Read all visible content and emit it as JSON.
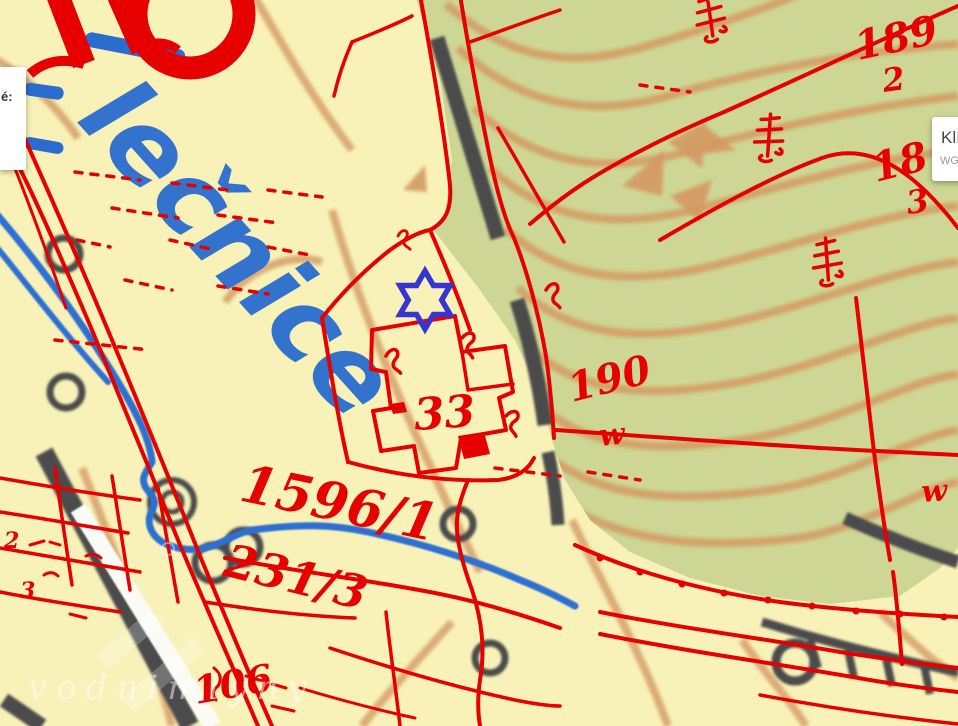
{
  "app": {
    "type": "historical-cadastral-map-viewer"
  },
  "panels": {
    "left_popup": {
      "text_fragment": "é:"
    },
    "right_popup": {
      "title_fragment": "Klí",
      "subtitle_fragment": "WG"
    }
  },
  "watermark": {
    "text": "vodnimlyny"
  },
  "marker": {
    "shape": "six-pointed-star-outline",
    "x": 425,
    "y": 300
  },
  "map": {
    "labels": {
      "stream_name": "lečnice",
      "parcel_1596": "1596/1",
      "parcel_231": "231/3",
      "house_33": "33",
      "num_189": "189",
      "num_189_sub": "2",
      "num_18": "18",
      "num_18_sub": "3",
      "num_190": "190",
      "w_forest_1": "w",
      "w_forest_2": "w",
      "num_106": "106",
      "small_2": "2",
      "small_3": "3"
    },
    "colors": {
      "paper": "#f8f2b9",
      "forest": "#cdd694",
      "contour": "#d49a63",
      "overlay_red": "#e60000",
      "water": "#2f70d2",
      "water_label": "#2a6dcf",
      "dark": "#4c4c4b",
      "marker": "#3535d2"
    }
  }
}
